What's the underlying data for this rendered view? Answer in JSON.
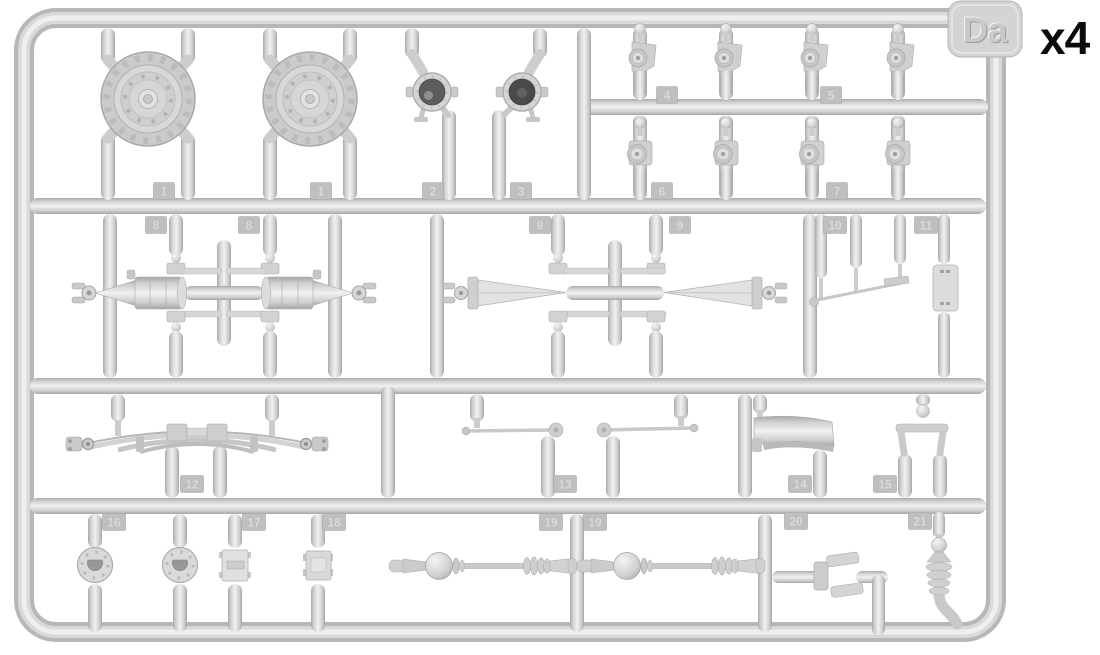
{
  "sprue": {
    "letter": "Da",
    "quantity_label": "x4"
  },
  "tags": [
    "1",
    "1",
    "2",
    "3",
    "4",
    "5",
    "6",
    "7",
    "8",
    "8",
    "9",
    "9",
    "10",
    "11",
    "12",
    "13",
    "14",
    "15",
    "16",
    "17",
    "18",
    "19",
    "19",
    "20",
    "21"
  ],
  "colors": {
    "plastic_light": "#f1f1f1",
    "plastic_mid": "#d4d4d4",
    "plastic_dark": "#a8a8a8",
    "lens_dark": "#4a4a4a",
    "background": "#ffffff",
    "label_text": "#0b0b0b"
  }
}
